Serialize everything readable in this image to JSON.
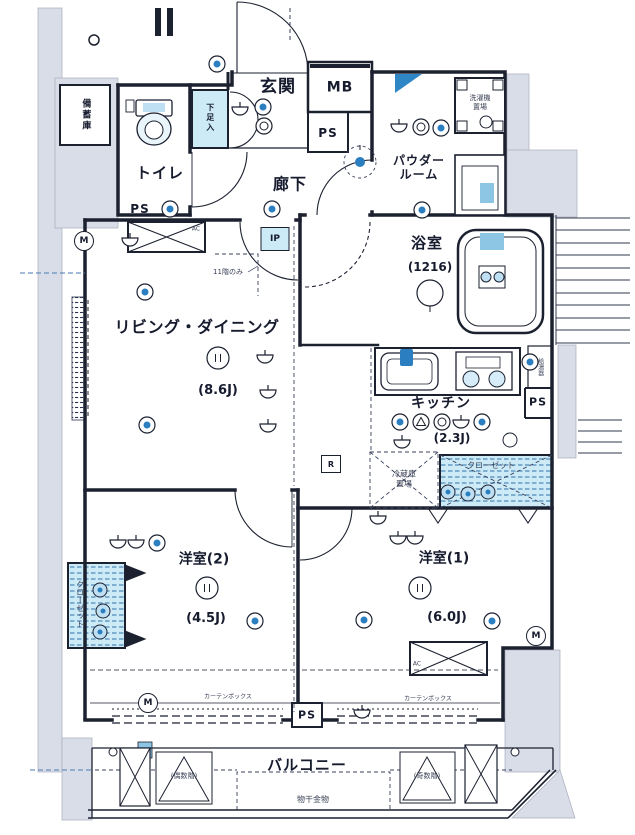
{
  "colors": {
    "line": "#1c2130",
    "accent_blue": "#2b7fc0",
    "fixture_blue": "#cdeaf7",
    "exterior_gray": "#d9dde7"
  },
  "rooms": {
    "entrance": {
      "label": "玄関"
    },
    "meter_box": {
      "label": "MB"
    },
    "toilet": {
      "label": "トイレ"
    },
    "hallway": {
      "label": "廊下"
    },
    "powder_room": {
      "label": "パウダー\nルーム"
    },
    "bathroom": {
      "label": "浴室",
      "size": "(1216)"
    },
    "living_dining": {
      "label": "リビング・ダイニング",
      "size": "(8.6J)"
    },
    "kitchen": {
      "label": "キッチン",
      "size": "(2.3J)"
    },
    "western_room_1": {
      "label": "洋室(1)",
      "size": "(6.0J)"
    },
    "western_room_2": {
      "label": "洋室(2)",
      "size": "(4.5J)"
    },
    "balcony": {
      "label": "バルコニー"
    }
  },
  "features": {
    "pipe_space": "PS",
    "shoe_cabinet": "下足入",
    "storage": "備蓄庫",
    "laundry_area": "洗濯機\n置場",
    "water_heater": "給湯器",
    "refrigerator_area": "冷蔵庫\n置場",
    "closet_kitchen": "クローゼット",
    "closet_room2": "クローゼット",
    "laundry_pole": "物干金物",
    "even_floors": "(偶数階)",
    "odd_floors": "(奇数階)",
    "curtain_box": "カーテンボックス",
    "ip_box": "IP",
    "ip_note": "11階のみ",
    "ac_mark": "AC",
    "m_mark": "M",
    "r_mark": "R"
  }
}
